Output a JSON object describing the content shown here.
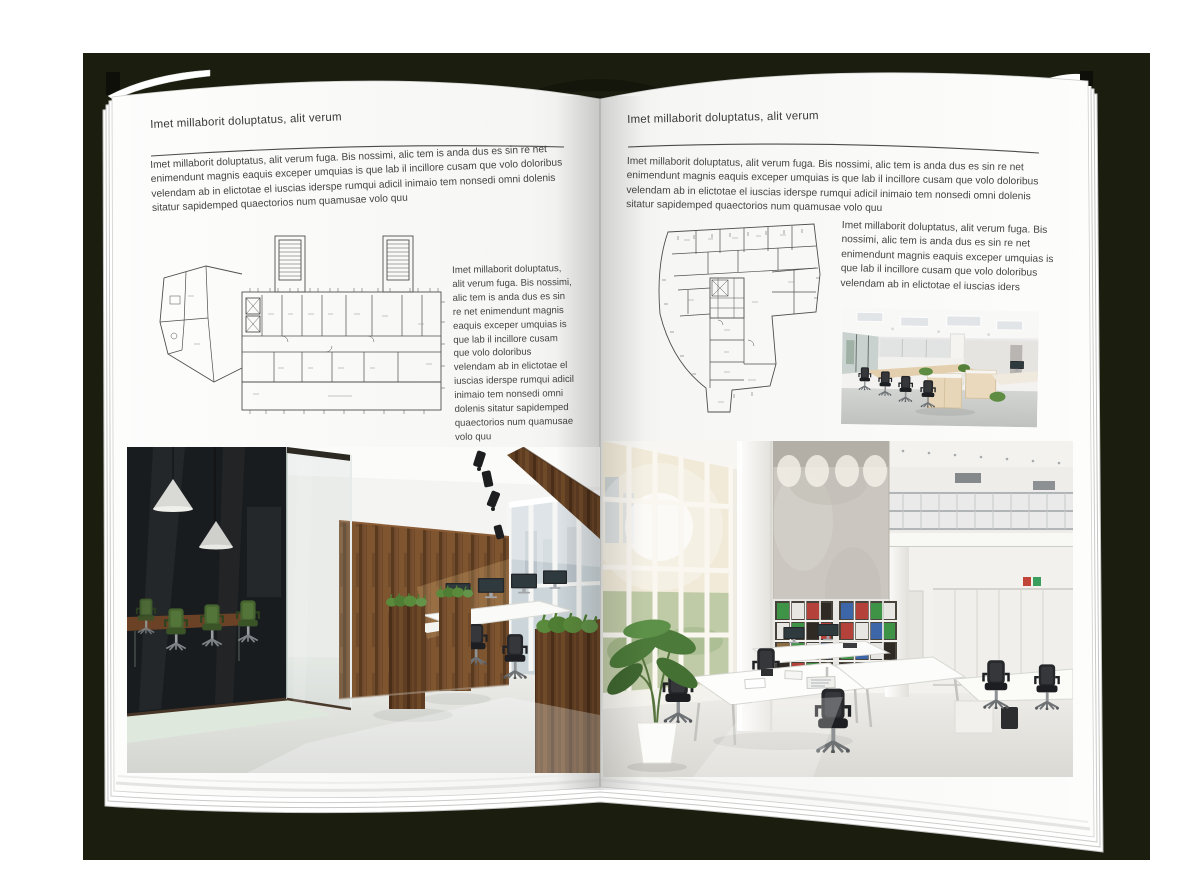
{
  "book": {
    "left_page": {
      "header": "Imet millaborit doluptatus, alit verum",
      "intro": "Imet millaborit doluptatus, alit verum fuga. Bis nossimi, alic tem is anda dus es sin re net enimendunt magnis eaquis exceper umquias is que lab il incillore cusam que volo doloribus velendam ab in elictotae el iuscias iderspe rumqui adicil inimaio tem nonsedi omni dolenis sitatur sapidemped quaectorios num quamusae volo quu",
      "caption": "Imet millaborit doluptatus, alit verum fuga. Bis nossimi, alic tem is anda dus es sin re net enimendunt magnis eaquis exceper umquias is que lab il incillore cusam que volo doloribus velendam ab in elictotae el iuscias iderspe rumqui adicil inimaio tem nonsedi omni dolenis sitatur sapidemped quaectorios num quamusae volo quu"
    },
    "right_page": {
      "header": "Imet millaborit doluptatus, alit verum",
      "intro": "Imet millaborit doluptatus, alit verum fuga. Bis nossimi, alic tem is anda dus es sin re net enimendunt magnis eaquis exceper umquias is que lab il incillore cusam que volo doloribus velendam ab in elictotae el iuscias iderspe rumqui adicil inimaio tem nonsedi omni dolenis sitatur sapidemped quaectorios num quamusae volo quu",
      "caption": "Imet millaborit doluptatus, alit verum fuga. Bis nossimi, alic tem is anda dus es sin re net enimendunt magnis eaquis exceper umquias is que lab il incillore cusam que volo doloribus velendam ab in elictotae el iuscias iders"
    },
    "colors": {
      "backdrop": "#1b1d0f",
      "page": "#ffffff",
      "text": "#414141"
    }
  }
}
